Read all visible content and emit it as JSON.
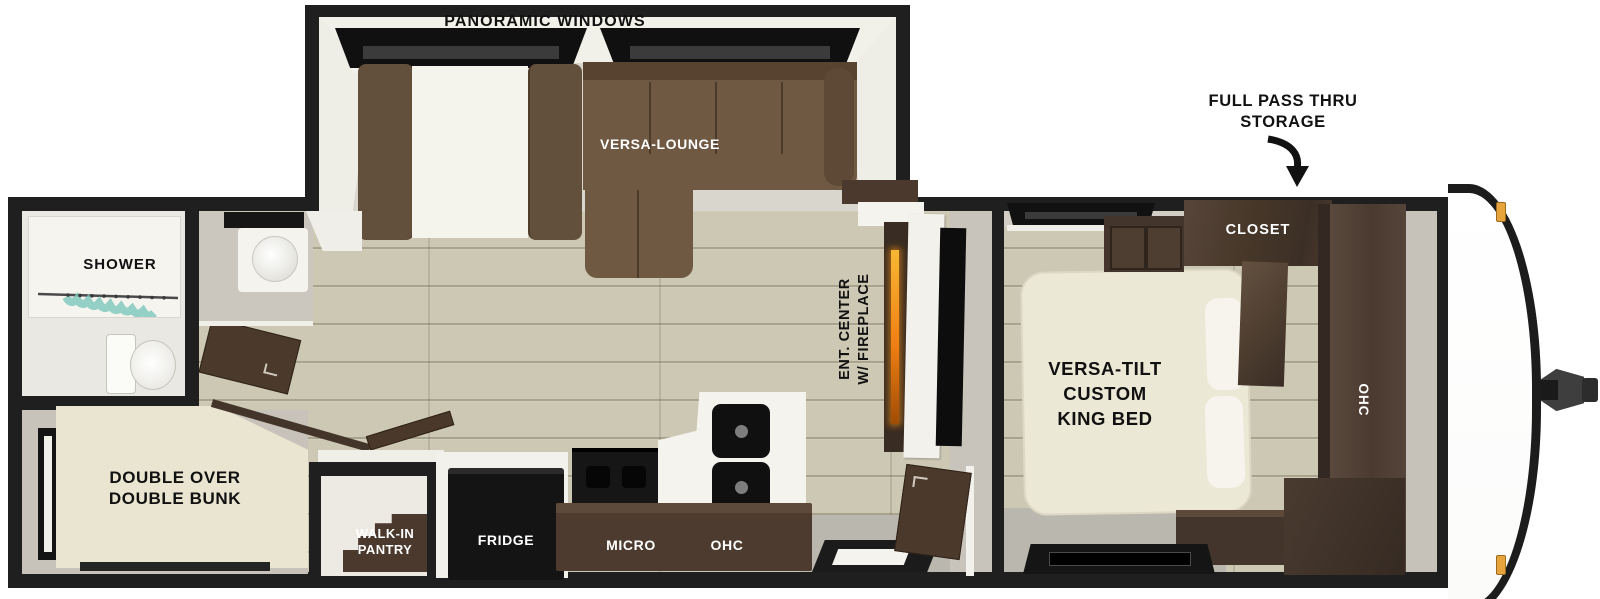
{
  "page": {
    "description": "Top-down RV travel trailer floor plan rendering",
    "background": "#ffffff"
  },
  "labels": {
    "panoramic_windows": "PANORAMIC WINDOWS",
    "versa_lounge": "VERSA-LOUNGE",
    "full_pass_thru_storage": [
      "FULL PASS THRU",
      "STORAGE"
    ],
    "closet": "CLOSET",
    "shower": "SHOWER",
    "ent_center_fireplace": [
      "ENT. CENTER",
      "W/ FIREPLACE"
    ],
    "king_bed": [
      "VERSA-TILT",
      "CUSTOM",
      "KING BED"
    ],
    "bedroom_ohc": "OHC",
    "double_bunk": [
      "DOUBLE OVER",
      "DOUBLE BUNK"
    ],
    "walk_in_pantry": [
      "WALK-IN",
      "PANTRY"
    ],
    "fridge": "FRIDGE",
    "micro": "MICRO",
    "kitchen_ohc": "OHC"
  },
  "colors": {
    "outline_black": "#1f1f1f",
    "floor_tan": "#cdc8b4",
    "floor_gray": "#b9b6ad",
    "wall_gray": "#cac6bd",
    "sofa_brown": "#6b5440",
    "bed_cream": "#ece8d6",
    "cabinet_dark_wood": "#4a3a2e",
    "appliance_black": "#141414",
    "fireplace_flame": "#f07f13",
    "shower_curtain_teal": "#7cc7ba",
    "marker_light_amber": "#e8a43c",
    "label_dark": "#111111",
    "label_light": "#ffffff"
  }
}
